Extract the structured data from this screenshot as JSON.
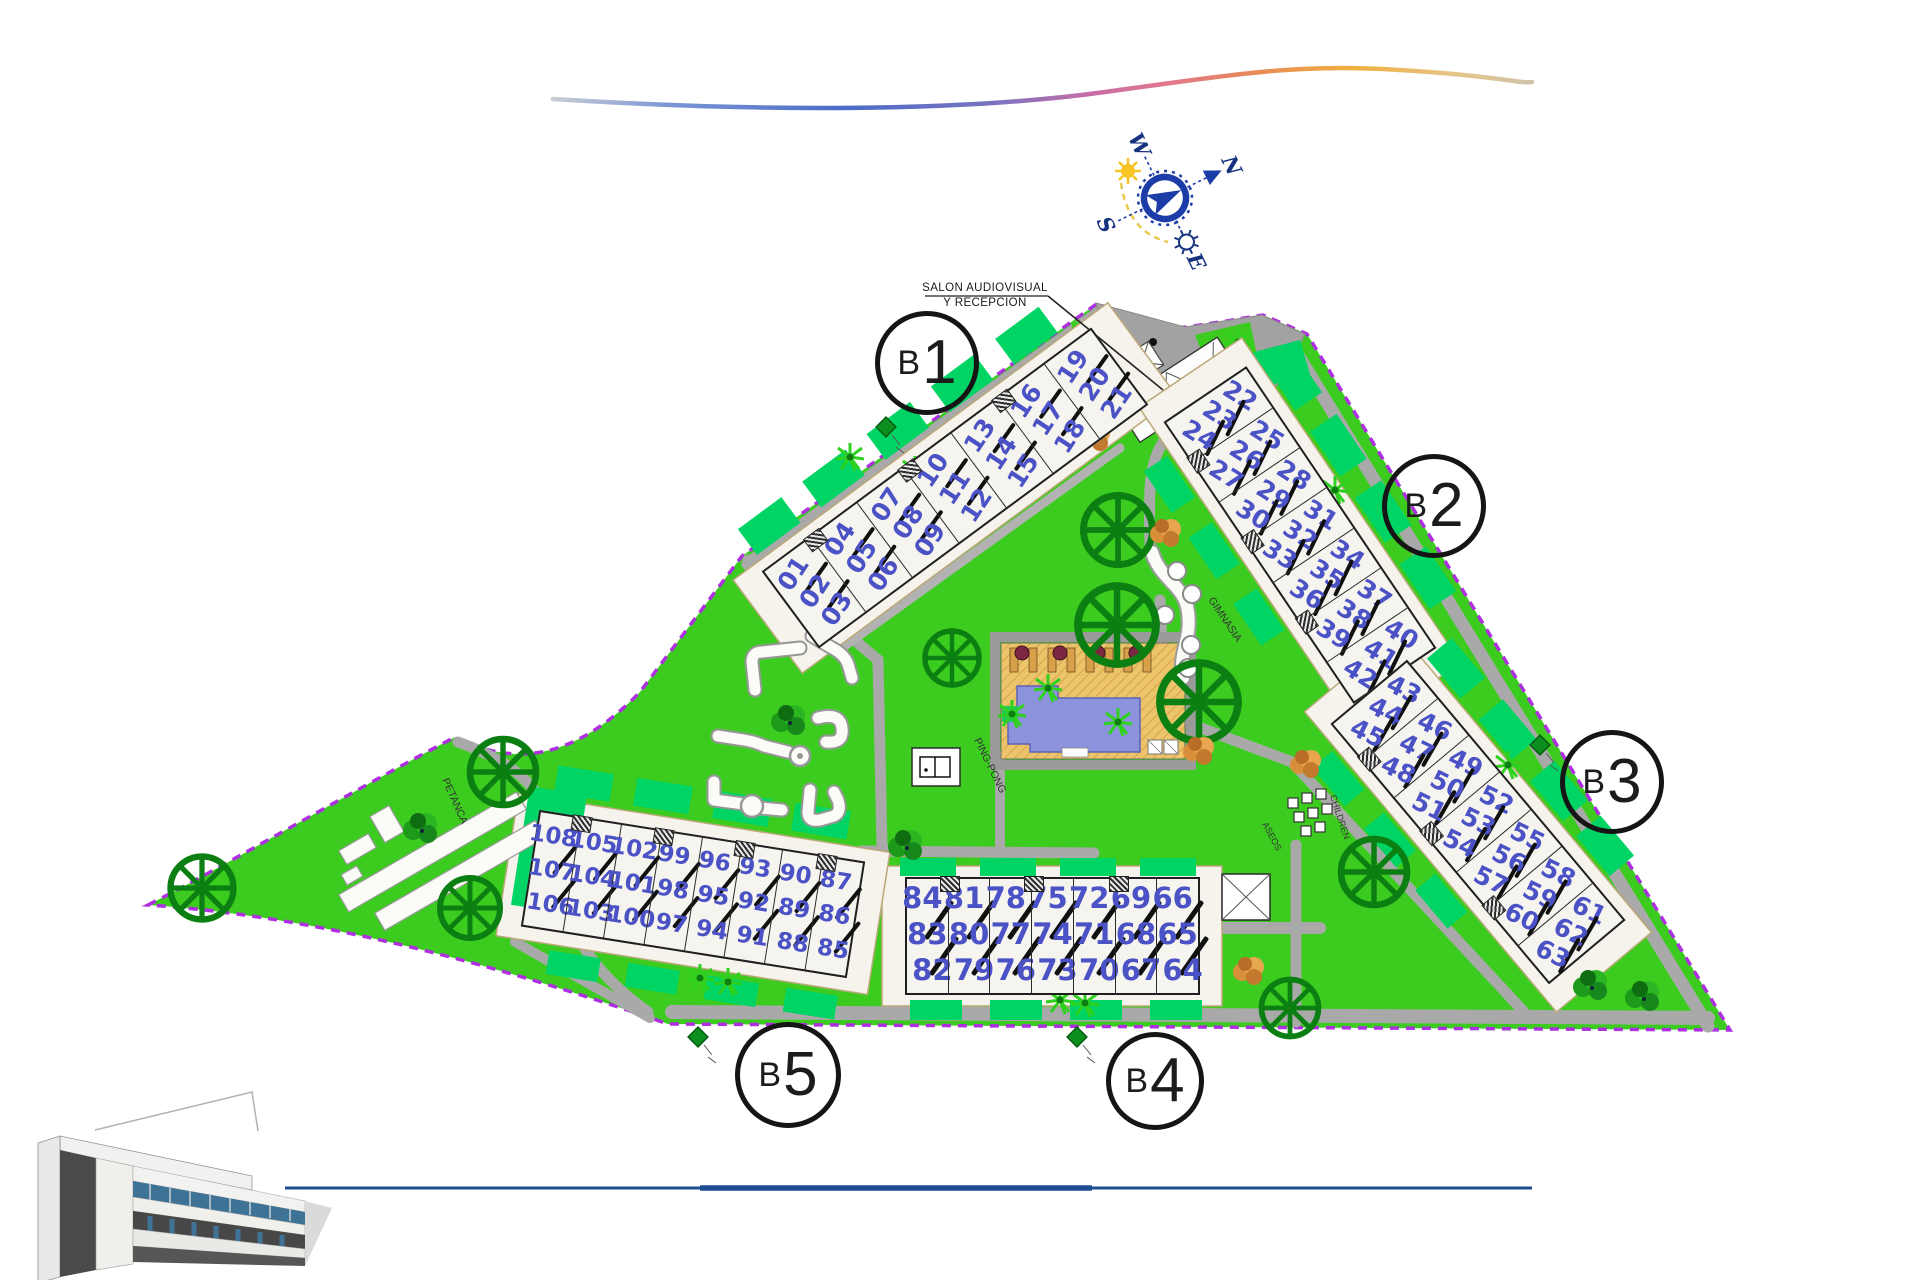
{
  "annotations": {
    "salon_line1": "SALON AUDIOVISUAL",
    "salon_line2": "Y RECEPCION",
    "petanca": "PETANCA",
    "ping_pong": "PING-PONG",
    "gimnasia": "GIMNASIA",
    "children": "CHILDREN",
    "aseos": "ASEOS"
  },
  "compass": {
    "north": "N",
    "south": "S",
    "east": "E",
    "west": "W"
  },
  "blocks": [
    {
      "label_prefix": "B",
      "label_number": "1",
      "units": [
        [
          "01",
          "02",
          "03"
        ],
        [
          "04",
          "05",
          "06"
        ],
        [
          "07",
          "08",
          "09"
        ],
        [
          "10",
          "11",
          "12"
        ],
        [
          "13",
          "14",
          "15"
        ],
        [
          "16",
          "17",
          "18"
        ],
        [
          "19",
          "20",
          "21"
        ]
      ]
    },
    {
      "label_prefix": "B",
      "label_number": "2",
      "units": [
        [
          "22",
          "23",
          "24"
        ],
        [
          "25",
          "26",
          "27"
        ],
        [
          "28",
          "29",
          "30"
        ],
        [
          "31",
          "32",
          "33"
        ],
        [
          "34",
          "35",
          "36"
        ],
        [
          "37",
          "38",
          "39"
        ],
        [
          "40",
          "41",
          "42"
        ]
      ]
    },
    {
      "label_prefix": "B",
      "label_number": "3",
      "units": [
        [
          "43",
          "44",
          "45"
        ],
        [
          "46",
          "47",
          "48"
        ],
        [
          "49",
          "50",
          "51"
        ],
        [
          "52",
          "53",
          "54"
        ],
        [
          "55",
          "56",
          "57"
        ],
        [
          "58",
          "59",
          "60"
        ],
        [
          "61",
          "62",
          "63"
        ]
      ]
    },
    {
      "label_prefix": "B",
      "label_number": "4",
      "units": [
        [
          "84",
          "83",
          "82"
        ],
        [
          "81",
          "80",
          "79"
        ],
        [
          "78",
          "77",
          "76"
        ],
        [
          "75",
          "74",
          "73"
        ],
        [
          "72",
          "71",
          "70"
        ],
        [
          "69",
          "68",
          "67"
        ],
        [
          "66",
          "65",
          "64"
        ]
      ]
    },
    {
      "label_prefix": "B",
      "label_number": "5",
      "units": [
        [
          "108",
          "107",
          "106"
        ],
        [
          "105",
          "104",
          "103"
        ],
        [
          "102",
          "101",
          "100"
        ],
        [
          "99",
          "98",
          "97"
        ],
        [
          "96",
          "95",
          "94"
        ],
        [
          "93",
          "92",
          "91"
        ],
        [
          "90",
          "89",
          "88"
        ],
        [
          "87",
          "86",
          "85"
        ]
      ]
    }
  ],
  "colors": {
    "lawn": "#3ccc20",
    "garden": "#00d465",
    "road": "#a9a9a9",
    "boundary": "#ae2fe0",
    "unit_number": "#4b52c6",
    "pool_water": "#8d92dc",
    "pool_deck": "#ecc46c",
    "tree": "#0b7f12",
    "palm": "#2fd11f",
    "compass_blue": "#1c3da8",
    "line_blue": "#1d4d8f"
  }
}
